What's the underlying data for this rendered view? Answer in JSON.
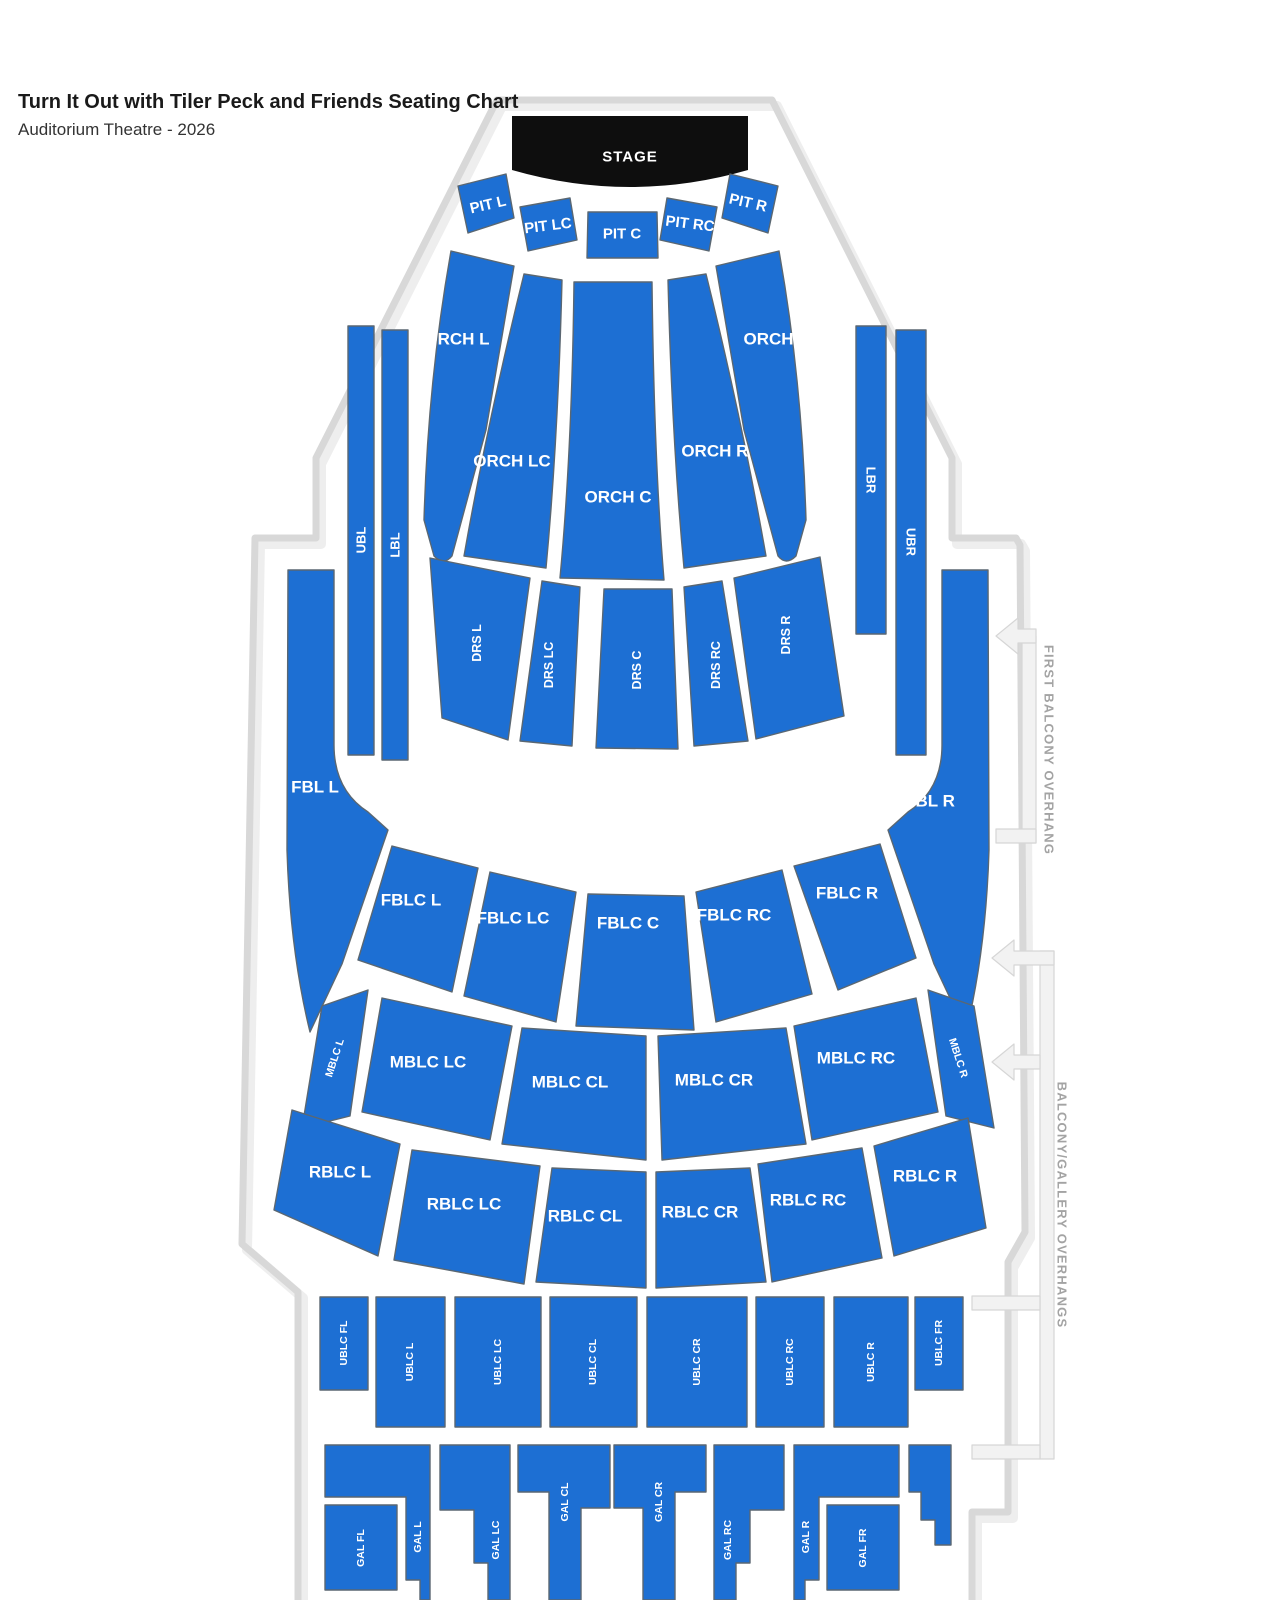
{
  "header": {
    "title": "Turn It Out with Tiler Peck and Friends Seating Chart",
    "subtitle": "Auditorium Theatre - 2026"
  },
  "stage": {
    "label": "STAGE"
  },
  "overhangs": {
    "first_balcony": "FIRST BALCONY OVERHANG",
    "balcony_gallery": "BALCONY/GALLERY OVERHANGS"
  },
  "colors": {
    "section_fill": "#1d6fd3",
    "section_border": "#5a6772",
    "stage_fill": "#0e0e0e",
    "section_label_text": "#ffffff",
    "venue_outline": "#d8d8d8",
    "bracket_fill": "#f2f2f2",
    "bracket_border": "#d6d6d6",
    "overhang_text": "#a3a3a3",
    "title_text": "#1a1a1a",
    "subtitle_text": "#333333"
  },
  "sections": {
    "pit_l": {
      "label": "PIT L"
    },
    "pit_lc": {
      "label": "PIT LC"
    },
    "pit_c": {
      "label": "PIT C"
    },
    "pit_rc": {
      "label": "PIT RC"
    },
    "pit_r": {
      "label": "PIT R"
    },
    "orch_l": {
      "label": "ORCH L"
    },
    "orch_lc": {
      "label": "ORCH LC"
    },
    "orch_c": {
      "label": "ORCH C"
    },
    "orch_rc": {
      "label": "ORCH RC"
    },
    "orch_r": {
      "label": "ORCH R"
    },
    "ubl": {
      "label": "UBL"
    },
    "lbl": {
      "label": "LBL"
    },
    "lbr": {
      "label": "LBR"
    },
    "ubr": {
      "label": "UBR"
    },
    "drs_l": {
      "label": "DRS L"
    },
    "drs_lc": {
      "label": "DRS LC"
    },
    "drs_c": {
      "label": "DRS C"
    },
    "drs_rc": {
      "label": "DRS RC"
    },
    "drs_r": {
      "label": "DRS R"
    },
    "fbl_l": {
      "label": "FBL L"
    },
    "fbl_r": {
      "label": "FBL R"
    },
    "fblc_l": {
      "label": "FBLC L"
    },
    "fblc_lc": {
      "label": "FBLC LC"
    },
    "fblc_c": {
      "label": "FBLC C"
    },
    "fblc_rc": {
      "label": "FBLC RC"
    },
    "fblc_r": {
      "label": "FBLC R"
    },
    "mblc_l": {
      "label": "MBLC L"
    },
    "mblc_lc": {
      "label": "MBLC LC"
    },
    "mblc_cl": {
      "label": "MBLC CL"
    },
    "mblc_cr": {
      "label": "MBLC CR"
    },
    "mblc_rc": {
      "label": "MBLC RC"
    },
    "mblc_r": {
      "label": "MBLC R"
    },
    "rblc_l": {
      "label": "RBLC L"
    },
    "rblc_lc": {
      "label": "RBLC LC"
    },
    "rblc_cl": {
      "label": "RBLC CL"
    },
    "rblc_cr": {
      "label": "RBLC CR"
    },
    "rblc_rc": {
      "label": "RBLC RC"
    },
    "rblc_r": {
      "label": "RBLC R"
    },
    "ublc_fl": {
      "label": "UBLC FL"
    },
    "ublc_l": {
      "label": "UBLC L"
    },
    "ublc_lc": {
      "label": "UBLC LC"
    },
    "ublc_cl": {
      "label": "UBLC CL"
    },
    "ublc_cr": {
      "label": "UBLC CR"
    },
    "ublc_rc": {
      "label": "UBLC RC"
    },
    "ublc_r": {
      "label": "UBLC R"
    },
    "ublc_fr": {
      "label": "UBLC FR"
    },
    "gal_fl": {
      "label": "GAL FL"
    },
    "gal_l": {
      "label": "GAL L"
    },
    "gal_lc": {
      "label": "GAL LC"
    },
    "gal_cl": {
      "label": "GAL CL"
    },
    "gal_cr": {
      "label": "GAL CR"
    },
    "gal_rc": {
      "label": "GAL RC"
    },
    "gal_r": {
      "label": "GAL R"
    },
    "gal_fr": {
      "label": "GAL FR"
    }
  }
}
